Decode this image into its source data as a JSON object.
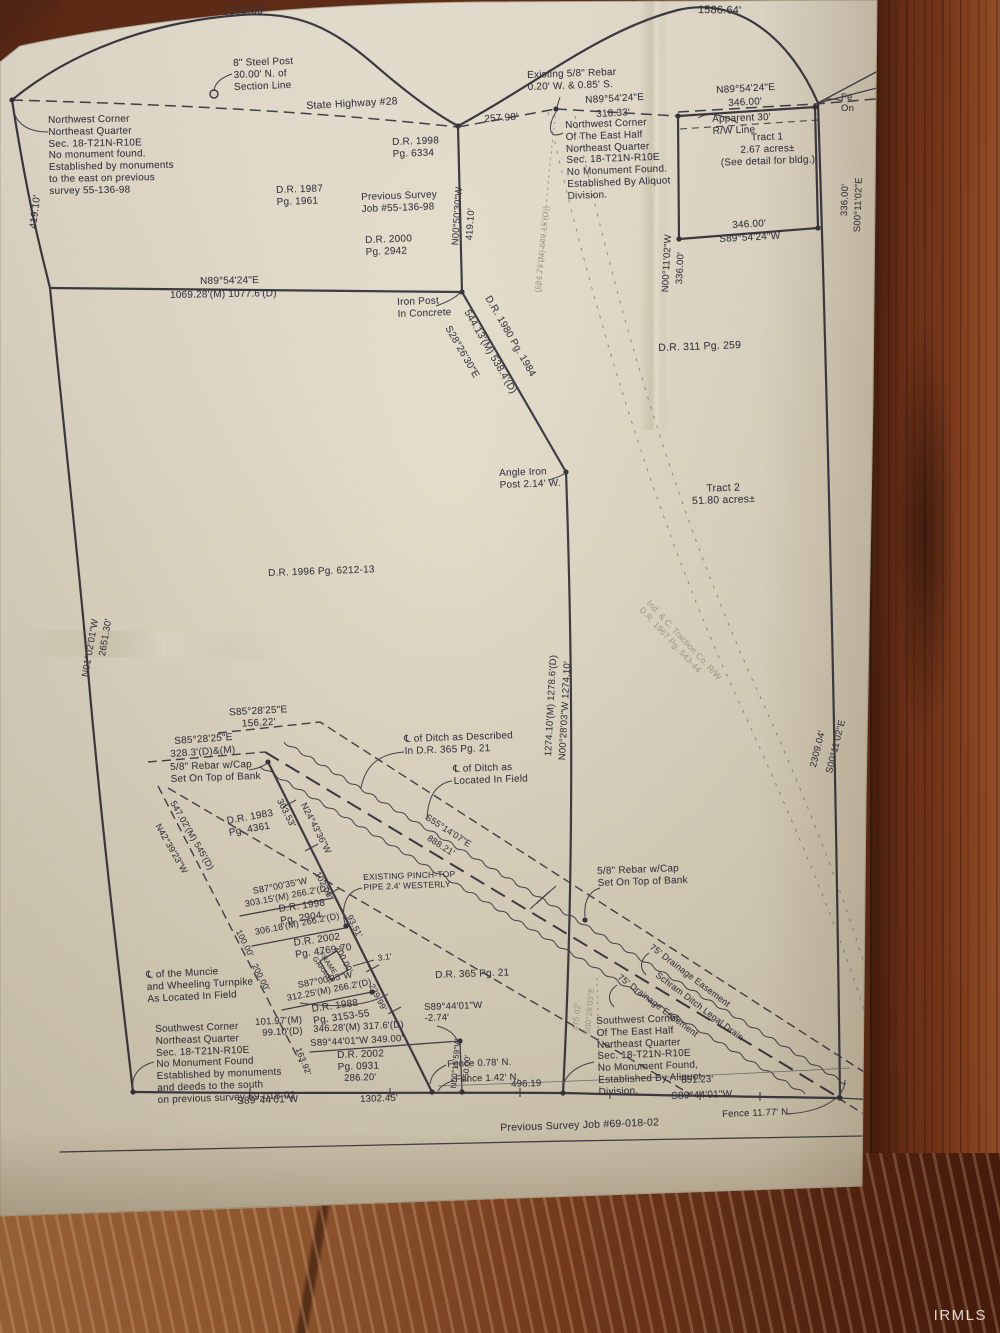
{
  "photo": {
    "watermark": "IRMLS"
  },
  "plat": {
    "ink_color": "#35353f",
    "paper_color": "#e4ddca",
    "labels": [
      {
        "t": "1070.69'",
        "x": 222,
        "y": 6,
        "r": -2,
        "s": 11,
        "id": "dim-top-arc-west"
      },
      {
        "t": "1586.64'",
        "x": 698,
        "y": 4,
        "r": 1,
        "s": 11,
        "id": "dim-top-arc-east"
      },
      {
        "t": "8\" Steel Post\n30.00' N. of\nSection Line",
        "x": 233,
        "y": 58,
        "r": -2,
        "s": 10,
        "id": "steel-post-note"
      },
      {
        "t": "State Highway #28",
        "x": 306,
        "y": 100,
        "r": -3,
        "s": 10.5,
        "id": "highway-label"
      },
      {
        "t": "Existing 5/8\" Rebar\n0.20' W. & 0.85' S.",
        "x": 527,
        "y": 70,
        "r": -2,
        "s": 10
      },
      {
        "t": "N89°54'24\"E",
        "x": 585,
        "y": 95,
        "r": -3,
        "s": 10
      },
      {
        "t": "318.33'",
        "x": 596,
        "y": 109,
        "r": -3,
        "s": 10
      },
      {
        "t": "257.98'",
        "x": 484,
        "y": 114,
        "r": -4,
        "s": 10
      },
      {
        "t": "N89°54'24\"E",
        "x": 716,
        "y": 85,
        "r": -3,
        "s": 10
      },
      {
        "t": "346.00'",
        "x": 728,
        "y": 98,
        "r": -3,
        "s": 10
      },
      {
        "t": "Apparent 30'\nR/W Line",
        "x": 712,
        "y": 114,
        "r": -2,
        "s": 10
      },
      {
        "t": "Fe\nOn",
        "x": 841,
        "y": 92,
        "r": 0,
        "s": 9.5
      },
      {
        "t": "Northwest Corner\nNortheast Quarter\nSec. 18-T21N-R10E\nNo monument found.\nEstablished by monuments\nto the east on previous\nsurvey 55-136-98",
        "x": 48,
        "y": 115,
        "r": -1,
        "s": 10,
        "id": "nw-corner-note"
      },
      {
        "t": "419.10'",
        "x": 28,
        "y": 228,
        "r": -83,
        "s": 10
      },
      {
        "t": "D.R. 1998\nPg. 6334",
        "x": 392,
        "y": 137,
        "r": -2,
        "s": 10
      },
      {
        "t": "D.R. 1987\nPg. 1961",
        "x": 276,
        "y": 185,
        "r": -2,
        "s": 10
      },
      {
        "t": "Previous Survey\nJob #55-136-98",
        "x": 361,
        "y": 192,
        "r": -2,
        "s": 10
      },
      {
        "t": "D.R. 2000\nPg. 2942",
        "x": 365,
        "y": 235,
        "r": -2,
        "s": 10
      },
      {
        "t": "N00°50'30\"W",
        "x": 450,
        "y": 245,
        "r": -86,
        "s": 9.5
      },
      {
        "t": "419.10'",
        "x": 464,
        "y": 240,
        "r": -86,
        "s": 9.5
      },
      {
        "t": "(684.79'(M) 689.15'(D))",
        "x": 533,
        "y": 292,
        "r": -84,
        "s": 8,
        "f": true
      },
      {
        "t": "Northwest Corner\nOf The East Half\nNortheast Quarter\nSec. 18-T21N-R10E\nNo Monument Found.\nEstablished By Aliquot\nDivision.",
        "x": 565,
        "y": 120,
        "r": -2,
        "s": 10,
        "id": "nw-corner-east-half-note"
      },
      {
        "t": "N00°11'02\"W",
        "x": 660,
        "y": 292,
        "r": -87,
        "s": 9.5
      },
      {
        "t": "336.00'",
        "x": 674,
        "y": 284,
        "r": -87,
        "s": 9.5
      },
      {
        "t": "Tract 1\n2.67 acres±\n(See detail for bldg.)",
        "x": 708,
        "y": 134,
        "r": -2,
        "s": 10,
        "al": "center",
        "w": 118,
        "id": "tract1-label"
      },
      {
        "t": "336.00'",
        "x": 839,
        "y": 216,
        "r": -88,
        "s": 9.5
      },
      {
        "t": "S00°11'02\"E",
        "x": 852,
        "y": 232,
        "r": -88,
        "s": 9.5
      },
      {
        "t": "346.00'",
        "x": 732,
        "y": 220,
        "r": -3,
        "s": 10
      },
      {
        "t": "S89°54'24\"W",
        "x": 719,
        "y": 234,
        "r": -3,
        "s": 10
      },
      {
        "t": "N89°54'24\"E",
        "x": 200,
        "y": 276,
        "r": -1,
        "s": 10
      },
      {
        "t": "1069.28'(M) 1077.6'(D)",
        "x": 170,
        "y": 290,
        "r": -1,
        "s": 10
      },
      {
        "t": "Iron Post\nIn Concrete",
        "x": 397,
        "y": 297,
        "r": -2,
        "s": 10
      },
      {
        "t": "D.R. 1980 Pg. 1984",
        "x": 492,
        "y": 294,
        "r": 60,
        "s": 10
      },
      {
        "t": "544.13'(M) 538.4'(D)",
        "x": 471,
        "y": 308,
        "r": 60,
        "s": 10
      },
      {
        "t": "S28°26'30\"E",
        "x": 452,
        "y": 324,
        "r": 60,
        "s": 10
      },
      {
        "t": "D.R. 311 Pg. 259",
        "x": 658,
        "y": 342,
        "r": -2,
        "s": 10.5
      },
      {
        "t": "Angle Iron\nPost 2.14' W.",
        "x": 499,
        "y": 468,
        "r": -2,
        "s": 10
      },
      {
        "t": "Tract 2\n51.80 acres±",
        "x": 668,
        "y": 484,
        "r": -2,
        "s": 10.5,
        "al": "center",
        "w": 110,
        "id": "tract2-label"
      },
      {
        "t": "D.R. 1996 Pg. 6212-13",
        "x": 268,
        "y": 568,
        "r": -2,
        "s": 10
      },
      {
        "t": "N01°02'01\"W",
        "x": 80,
        "y": 676,
        "r": -80,
        "s": 9.5
      },
      {
        "t": "2651.30'",
        "x": 97,
        "y": 655,
        "r": -80,
        "s": 9.5
      },
      {
        "t": "S85°28'25\"E\n156.22'",
        "x": 216,
        "y": 708,
        "r": -3,
        "s": 10,
        "al": "center",
        "w": 84
      },
      {
        "t": "S85°28'25\"E",
        "x": 174,
        "y": 736,
        "r": -4,
        "s": 10
      },
      {
        "t": "328.3'(D)&(M)",
        "x": 170,
        "y": 749,
        "r": -4,
        "s": 10
      },
      {
        "t": "5/8\" Rebar w/Cap\nSet On Top of Bank",
        "x": 170,
        "y": 762,
        "r": -2,
        "s": 10
      },
      {
        "t": "℄ of Ditch as Described\nIn D.R. 365 Pg. 21",
        "x": 404,
        "y": 734,
        "r": -2,
        "s": 10
      },
      {
        "t": "℄ of Ditch as\nLocated In Field",
        "x": 453,
        "y": 764,
        "r": -2,
        "s": 10
      },
      {
        "t": "1274.10'(M) 1278.6'(D)",
        "x": 543,
        "y": 756,
        "r": -87,
        "s": 9.5
      },
      {
        "t": "N00°28'03\"W  1274.10'",
        "x": 557,
        "y": 760,
        "r": -87,
        "s": 9.5
      },
      {
        "t": "Ind. & C. Traction Co. R/W\nD.R. 1967 Pg. 543-44",
        "x": 652,
        "y": 598,
        "r": 47,
        "s": 8.5,
        "f": true
      },
      {
        "t": "303.53'",
        "x": 284,
        "y": 797,
        "r": 63,
        "s": 9
      },
      {
        "t": "N24°43'36\"W",
        "x": 308,
        "y": 801,
        "r": 63,
        "s": 9
      },
      {
        "t": "547.02'(M) 545'(D)",
        "x": 177,
        "y": 799,
        "r": 60,
        "s": 9
      },
      {
        "t": "N42°39'23\"W",
        "x": 162,
        "y": 822,
        "r": 60,
        "s": 9
      },
      {
        "t": "D.R. 1983\nPg. 4361",
        "x": 226,
        "y": 816,
        "r": -10,
        "s": 10
      },
      {
        "t": "S87°00'35\"W",
        "x": 252,
        "y": 886,
        "r": -11,
        "s": 9
      },
      {
        "t": "303.15'(M) 266.2'(D)",
        "x": 244,
        "y": 899,
        "r": -11,
        "s": 9
      },
      {
        "t": "D.R. 1998\nPg. 2904",
        "x": 278,
        "y": 904,
        "r": -8,
        "s": 10
      },
      {
        "t": "306.18'(M) 266.2'(D)",
        "x": 254,
        "y": 927,
        "r": -11,
        "s": 9
      },
      {
        "t": "100.00'",
        "x": 243,
        "y": 928,
        "r": 63,
        "s": 8.5
      },
      {
        "t": "200.00'",
        "x": 259,
        "y": 962,
        "r": 63,
        "s": 8.5
      },
      {
        "t": "D.R. 2002\nPg. 4769-70",
        "x": 293,
        "y": 938,
        "r": -8,
        "s": 10
      },
      {
        "t": "FRAME\nGARAGE",
        "x": 323,
        "y": 951,
        "r": 55,
        "s": 7
      },
      {
        "t": "3.1'",
        "x": 377,
        "y": 953,
        "r": -8,
        "s": 8.5
      },
      {
        "t": "S87°00'35\"W",
        "x": 297,
        "y": 980,
        "r": -11,
        "s": 9
      },
      {
        "t": "312.25'(M) 266.2'(D)",
        "x": 286,
        "y": 993,
        "r": -11,
        "s": 9
      },
      {
        "t": "D.R. 1988\nPg. 3153-55",
        "x": 311,
        "y": 1004,
        "r": -8,
        "s": 10
      },
      {
        "t": "102.00'",
        "x": 322,
        "y": 870,
        "r": 63,
        "s": 8.5
      },
      {
        "t": "93.51'",
        "x": 354,
        "y": 913,
        "r": 63,
        "s": 8.5
      },
      {
        "t": "200.00'",
        "x": 342,
        "y": 944,
        "r": 63,
        "s": 8.5
      },
      {
        "t": "239.99'",
        "x": 376,
        "y": 982,
        "r": 63,
        "s": 8.5
      },
      {
        "t": "℄ of the Muncie\nand Wheeling Turnpike\nAs Located In Field",
        "x": 146,
        "y": 970,
        "r": -3,
        "s": 10,
        "id": "turnpike-note"
      },
      {
        "t": "101.97'(M)\n99.10'(D)",
        "x": 236,
        "y": 1018,
        "r": -3,
        "s": 9.5,
        "al": "right",
        "w": 66
      },
      {
        "t": "Southwest Corner\nNortheast Quarter\nSec. 18-T21N-R10E\nNo Monument Found\nEstablished by monuments\nand deeds to the south\non previous survey 69-018-02",
        "x": 155,
        "y": 1024,
        "r": -2,
        "s": 10,
        "id": "sw-corner-note"
      },
      {
        "t": "163.92'",
        "x": 303,
        "y": 1046,
        "r": 68,
        "s": 8.5
      },
      {
        "t": "346.28'(M) 317.6'(D)",
        "x": 313,
        "y": 1024,
        "r": -3,
        "s": 9.5
      },
      {
        "t": "S89°44'01\"W     349.00'",
        "x": 310,
        "y": 1038,
        "r": -3,
        "s": 9.5
      },
      {
        "t": "S89°44'01\"W\n-2.74'",
        "x": 424,
        "y": 1002,
        "r": -2,
        "s": 9.5
      },
      {
        "t": "D.R. 2002\nPg. 0931",
        "x": 337,
        "y": 1050,
        "r": -2,
        "s": 10
      },
      {
        "t": "286.20'",
        "x": 344,
        "y": 1073,
        "r": -2,
        "s": 9.5
      },
      {
        "t": "1302.45'",
        "x": 360,
        "y": 1094,
        "r": -2,
        "s": 9.5
      },
      {
        "t": "S89°44'01\"W",
        "x": 237,
        "y": 1096,
        "r": -2,
        "s": 10
      },
      {
        "t": "N00°15'59\"W",
        "x": 449,
        "y": 1088,
        "r": -85,
        "s": 8
      },
      {
        "t": "150.00'",
        "x": 461,
        "y": 1082,
        "r": -85,
        "s": 8
      },
      {
        "t": "Fence 0.78' N.",
        "x": 447,
        "y": 1059,
        "r": -2,
        "s": 9.5
      },
      {
        "t": "Fence 1.42' N.",
        "x": 455,
        "y": 1074,
        "r": -2,
        "s": 9.5
      },
      {
        "t": "496.19",
        "x": 511,
        "y": 1079,
        "r": -2,
        "s": 9.5
      },
      {
        "t": "Southwest Corner\nOf The East Half\nNortheast Quarter\nSec. 18-T21N-R10E\nNo Monument Found,\nEstablished By Aliquot\nDivision.",
        "x": 596,
        "y": 1016,
        "r": -2,
        "s": 10,
        "id": "sw-corner-east-half-note"
      },
      {
        "t": "651.23'",
        "x": 681,
        "y": 1075,
        "r": -2,
        "s": 9.5
      },
      {
        "t": "S89°44'01\"W",
        "x": 671,
        "y": 1091,
        "r": -2,
        "s": 10
      },
      {
        "t": "Fence 11.77' N.",
        "x": 722,
        "y": 1109,
        "r": -2,
        "s": 9.5
      },
      {
        "t": "Previous Survey Job #69-018-02",
        "x": 500,
        "y": 1122,
        "r": -2,
        "s": 10.5,
        "id": "previous-survey-note"
      },
      {
        "t": "75' Drainage Easement",
        "x": 654,
        "y": 942,
        "r": 37,
        "s": 9
      },
      {
        "t": "Schram Ditch Legal Drain",
        "x": 660,
        "y": 970,
        "r": 37,
        "s": 9,
        "id": "ditch-name-label"
      },
      {
        "t": "75' Drainage Easement",
        "x": 622,
        "y": 972,
        "r": 37,
        "s": 9
      },
      {
        "t": "5/8\" Rebar w/Cap\nSet On Top of Bank",
        "x": 597,
        "y": 866,
        "r": -2,
        "s": 10
      },
      {
        "t": "EXISTING PINCH-TOP\nPIPE 2.4' WESTERLY",
        "x": 363,
        "y": 872,
        "r": -2,
        "s": 8.5
      },
      {
        "t": "S55°14'07\"E",
        "x": 429,
        "y": 812,
        "r": 33,
        "s": 9
      },
      {
        "t": "888.21'",
        "x": 431,
        "y": 833,
        "r": 33,
        "s": 9
      },
      {
        "t": "D.R. 365 Pg. 21",
        "x": 435,
        "y": 970,
        "r": -2,
        "s": 10
      },
      {
        "t": "475.02'",
        "x": 571,
        "y": 1030,
        "r": -85,
        "s": 8,
        "f": true
      },
      {
        "t": "S00°28'03\"E",
        "x": 583,
        "y": 1034,
        "r": -85,
        "s": 8,
        "f": true
      },
      {
        "t": "2309.04'",
        "x": 808,
        "y": 766,
        "r": -76,
        "s": 9.5
      },
      {
        "t": "S00°11'02\"E",
        "x": 824,
        "y": 772,
        "r": -76,
        "s": 9.5
      }
    ]
  }
}
